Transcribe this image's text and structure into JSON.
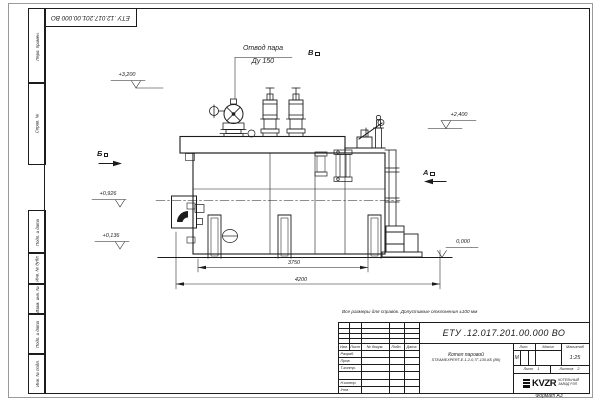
{
  "sheet": {
    "top_stamp": "ЕТУ .12.017.201.00.000  ВО",
    "side_labels": [
      "Перв. примен.",
      "Справ. №",
      "Подп. и дата",
      "Инв. № дубл.",
      "Взам. инв. №",
      "Подп. и дата",
      "Инв. № подл."
    ],
    "format_label": "Формат А3"
  },
  "drawing": {
    "note": "Все размеры для справок. Допустимые отклонения ±100 мм",
    "steam_outlet": {
      "line1": "Отвод пара",
      "line2": "Ду 150"
    },
    "views": {
      "a": "А",
      "b": "Б",
      "v": "В"
    },
    "elevations": {
      "e3200": "+3,200",
      "e2400": "+2,400",
      "e0926": "+0,926",
      "e0136": "+0,136",
      "e0000": "0,000"
    },
    "dimensions": {
      "d3750": "3750",
      "d4200": "4200"
    }
  },
  "title_block": {
    "doc_number": "ЕТУ .12.017.201.00.000  ВО",
    "header_cols": [
      "Изм.",
      "Лист",
      "№ докум.",
      "Подп.",
      "Дата"
    ],
    "sign_rows": [
      "Разраб.",
      "Пров.",
      "Т.контр.",
      "",
      "Н.контр.",
      "Утв."
    ],
    "product_name_line1": "Котел паровой",
    "product_name_line2": "STEAMEXPERT-Е-1,2-0,7Г-130-КБ (ВК)",
    "lit_header": "Лит.",
    "mass_header": "Масса",
    "scale_header": "Масштаб",
    "lit_value": "М",
    "scale_value": "1:25",
    "sheet_label": "Лист",
    "sheet_number": "1",
    "sheets_label": "Листов",
    "sheets_total": "2",
    "logo_text": "KVZR",
    "org_line1": "КОТЕЛЬНЫЙ",
    "org_line2": "ЗАВОД РЭП"
  },
  "colors": {
    "ink": "#1c1c1c",
    "paper": "#ffffff"
  }
}
